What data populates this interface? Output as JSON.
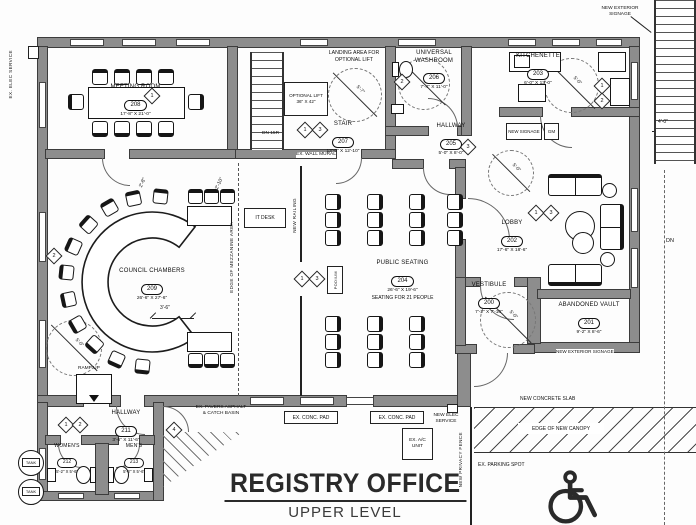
{
  "title_block": {
    "title": "REGISTRY OFFICE",
    "subtitle": "UPPER LEVEL"
  },
  "rooms": {
    "meeting_room": {
      "name": "MEETING ROOM",
      "number": "208",
      "dims": "17'-8\" X 21'-0\""
    },
    "stair": {
      "name": "STAIR",
      "number": "207",
      "dims": "13'-6\" X 12'-10\""
    },
    "universal_washroom": {
      "name": "UNIVERSAL WASHROOM",
      "number": "206",
      "dims": "7'-4\" X 11'-0\""
    },
    "hallway_205": {
      "name": "HALLWAY",
      "number": "205",
      "dims": "5'-0\" X 8'-0\""
    },
    "kitchenette": {
      "name": "KITCHENETTE",
      "number": "203",
      "dims": "6'-0\" X 13'-0\""
    },
    "council_chambers": {
      "name": "COUNCIL CHAMBERS",
      "number": "209",
      "dims": "26'-6\" X 27'-6\""
    },
    "public_seating": {
      "name": "PUBLIC SEATING",
      "number": "204",
      "dims": "26'-6\" X 19'-6\"",
      "note": "SEATING FOR 21 PEOPLE"
    },
    "lobby": {
      "name": "LOBBY",
      "number": "202",
      "dims": "17'-6\" X 18'-6\""
    },
    "vestibule": {
      "name": "VESTIBULE",
      "number": "200",
      "dims": "7'-2\" X 7'-10\""
    },
    "abandoned_vault": {
      "name": "ABANDONED VAULT",
      "number": "201",
      "dims": "9'-2\" X 8'-6\""
    },
    "hallway_211": {
      "name": "HALLWAY",
      "number": "211",
      "dims": "3'-6\" X 11'-6\""
    },
    "womens": {
      "name": "WOMEN'S",
      "number": "212",
      "dims": "5'-2\" X 5'-6\""
    },
    "mens": {
      "name": "MEN'S",
      "number": "213",
      "dims": "5'-2\" X 5'-6\""
    }
  },
  "labels": {
    "landing_area": "LANDING AREA FOR OPTIONAL LIFT",
    "optional_lift": "OPTIONAL LIFT",
    "optional_lift_size": "36\" X 42\"",
    "dn_15r": "DN 15R",
    "ex_wall_mural": "EX. WALL MURAL",
    "it_desk": "IT DESK",
    "podium": "PODIUM",
    "new_railing": "NEW RAILING",
    "edge_of_area": "EDGE OF MEZZANINE AREA",
    "ramp_up": "RAMP UP",
    "tank": "TANK",
    "ex_pavers": "EX. PAVERS ASPHALT & CATCH BASIN",
    "ex_conc_pad": "EX. CONC. PAD",
    "new_elec_service": "NEW ELEC SERVICE",
    "ex_ac_unit": "EX. A/C UNIT",
    "new_concrete_slab": "NEW CONCRETE SLAB",
    "edge_of_new_canopy": "EDGE OF NEW CANOPY",
    "ex_parking_spot": "EX. PARKING SPOT",
    "new_privacy_fence": "NEW PRIVACY FENCE",
    "new_exterior_signage": "NEW EXTERIOR SIGNAGE",
    "new_signage": "NEW SIGNAGE",
    "gm": "GM",
    "ex_elec_service": "EX. ELEC SERVICE",
    "dn": "DN"
  },
  "dims": {
    "aisle_a": "2'-8\"",
    "aisle_b": "2'-10\"",
    "gap_3_6": "3'-6\"",
    "stair_4_0": "4'-0\"",
    "turn_5_7": "5'-7\"",
    "turn_5_0": "5'-0\""
  },
  "markers": {
    "one": "1",
    "two": "2",
    "three": "3",
    "four": "4"
  }
}
